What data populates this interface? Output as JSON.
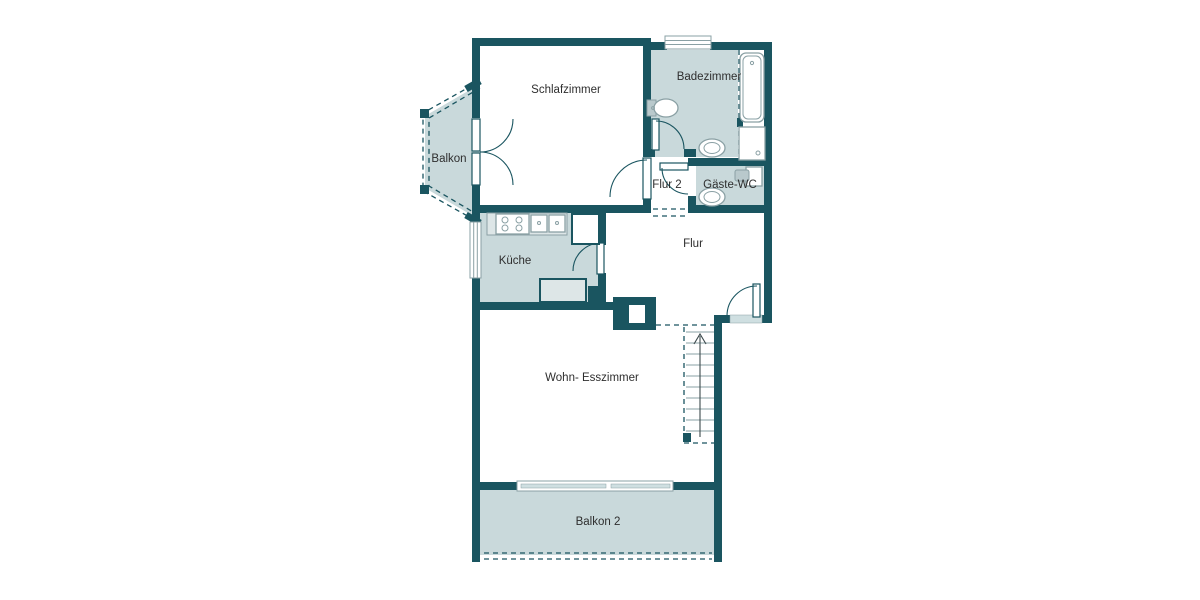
{
  "plan": {
    "type": "apartment-floor-plan",
    "language": "de"
  },
  "colors": {
    "wall": "#1a5560",
    "room_fill": "#c9d9db",
    "counter_fill": "#dde6e7",
    "window_fill": "#cfdfe1",
    "fixture_stroke": "#8aa0a4",
    "text": "#2e2e2e",
    "background": "#ffffff"
  },
  "rooms": {
    "schlafzimmer": {
      "label": "Schlafzimmer"
    },
    "balkon": {
      "label": "Balkon"
    },
    "badezimmer": {
      "label": "Badezimmer"
    },
    "flur2": {
      "label": "Flur 2"
    },
    "gaeste_wc": {
      "label": "Gäste-WC"
    },
    "kueche": {
      "label": "Küche"
    },
    "flur": {
      "label": "Flur"
    },
    "wohn_esszimmer": {
      "label": "Wohn- Esszimmer"
    },
    "balkon2": {
      "label": "Balkon 2"
    }
  }
}
